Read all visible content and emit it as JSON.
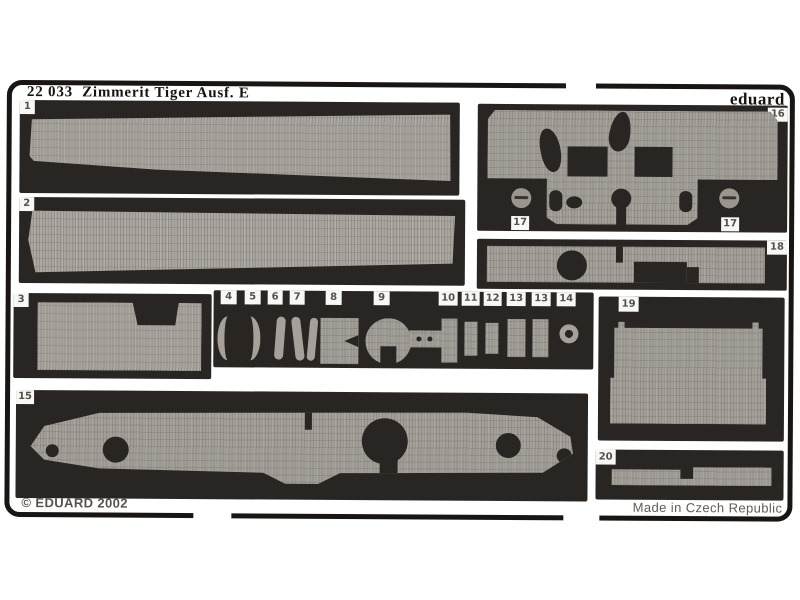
{
  "header": {
    "catalog_number": "22 033",
    "title": "Zimmerit Tiger Ausf. E",
    "brand": "eduard"
  },
  "footer": {
    "copyright": "© EDUARD 2002",
    "made_in": "Made in Czech Republic"
  },
  "parts": {
    "p1": "1",
    "p2": "2",
    "p3": "3",
    "p4": "4",
    "p5": "5",
    "p6": "6",
    "p7": "7",
    "p8": "8",
    "p9": "9",
    "p10": "10",
    "p11": "11",
    "p12": "12",
    "p13a": "13",
    "p13b": "13",
    "p14": "14",
    "p15": "15",
    "p16": "16",
    "p17a": "17",
    "p17b": "17",
    "p18": "18",
    "p19": "19",
    "p20": "20"
  },
  "colors": {
    "page_background": "#ffffff",
    "fret_background": "#292522",
    "metal_plate": "#a9a59e",
    "frame_outline": "#191513",
    "label_text": "#55504a"
  }
}
